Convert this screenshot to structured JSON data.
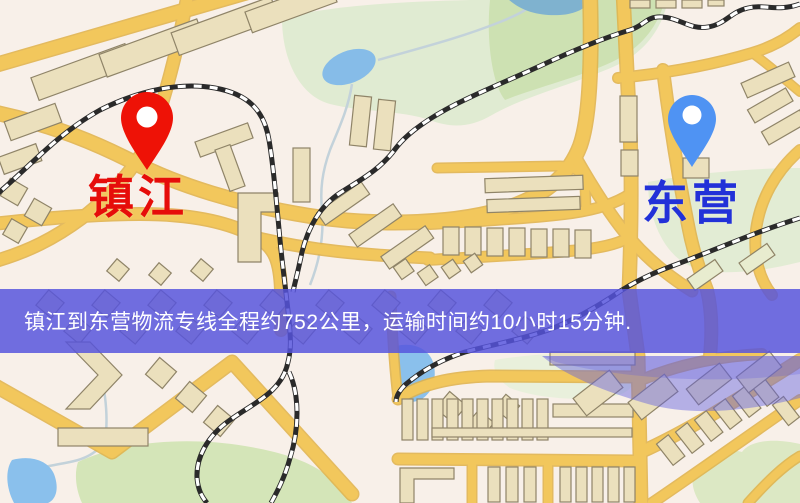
{
  "map": {
    "origin": {
      "label": "镇江"
    },
    "destination": {
      "label": "东营"
    }
  },
  "banner": {
    "text": "镇江到东营物流专线全程约752公里，运输时间约10小时15分钟."
  },
  "colors": {
    "pin_red": "#ee1206",
    "origin_label_color": "#e60d0a",
    "pin_blue": "#4f93f3",
    "destination_label_color": "#2231d8",
    "banner_background": "#5654dc",
    "banner_text": "#ffffff",
    "road_yellow": "#f2c75c",
    "road_casing": "#e0b148",
    "map_background": "#f8f0e9",
    "park_green": "#d5e5bb",
    "water_blue": "#8ac0ec",
    "railway_dark": "#2a2a2a"
  }
}
